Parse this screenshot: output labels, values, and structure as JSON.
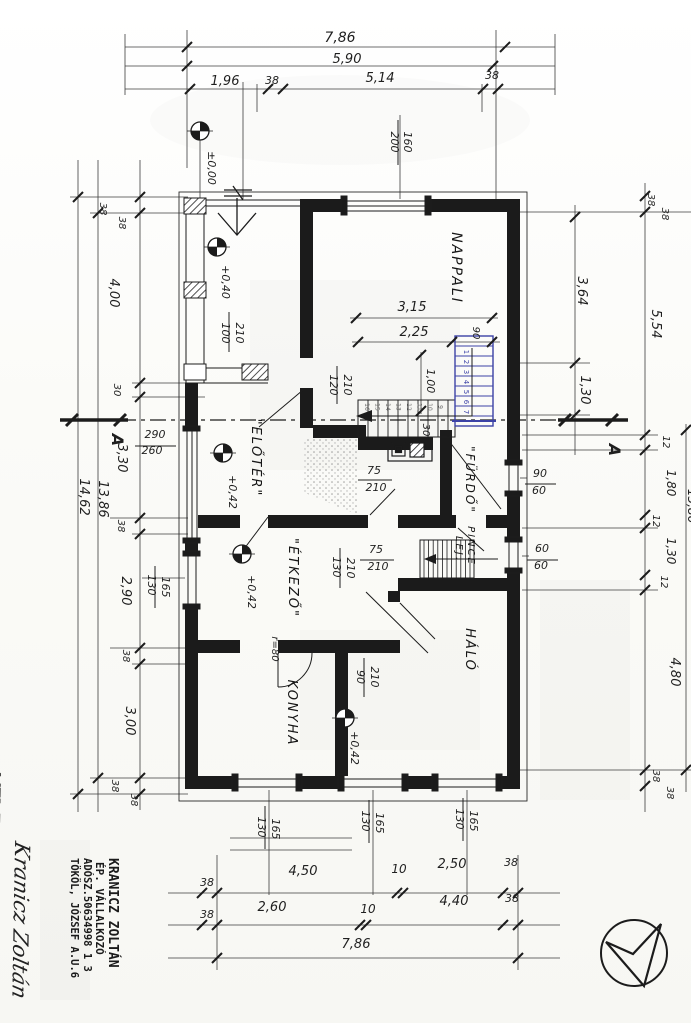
{
  "meta": {
    "drawing_type": "hand-drawn house floor plan (scanned, rotated 90°)",
    "language": "Hungarian"
  },
  "colors": {
    "ink": "#1f1f1f",
    "thin_line": "#3c3c3c",
    "blue_pen": "#3c42a6",
    "pencil": "#6a6a6a",
    "paper": "#fcfcfa"
  },
  "rooms_visible": [
    "NAPPALI",
    "ELŐTÉR",
    "FÜRDŐ",
    "PINCE LEJ.",
    "ÉTKEZŐ",
    "KONYHA",
    "HÁLÓ"
  ],
  "level_marks": [
    {
      "x": 200,
      "y": 131
    },
    {
      "x": 217,
      "y": 247
    },
    {
      "x": 223,
      "y": 453
    },
    {
      "x": 242,
      "y": 554
    },
    {
      "x": 345,
      "y": 718
    }
  ],
  "labels": [
    {
      "t": "7,86",
      "x": 340,
      "y": 42,
      "r": 0,
      "s": 14
    },
    {
      "t": "5,90",
      "x": 347,
      "y": 63,
      "r": 0,
      "s": 13
    },
    {
      "t": "1,96",
      "x": 225,
      "y": 85,
      "r": 0,
      "s": 13
    },
    {
      "t": "38",
      "x": 272,
      "y": 84,
      "r": 0,
      "s": 11
    },
    {
      "t": "5,14",
      "x": 380,
      "y": 82,
      "r": 0,
      "s": 13
    },
    {
      "t": "38",
      "x": 492,
      "y": 79,
      "r": 0,
      "s": 11
    },
    {
      "t": "±0,00",
      "x": 208,
      "y": 168,
      "r": 90,
      "s": 11
    },
    {
      "t": "200",
      "x": 391,
      "y": 142,
      "r": 90,
      "s": 11
    },
    {
      "t": "160",
      "x": 404,
      "y": 142,
      "r": 90,
      "s": 11
    },
    {
      "t": "38",
      "x": 100,
      "y": 209,
      "r": 90,
      "s": 10
    },
    {
      "t": "38",
      "x": 119,
      "y": 223,
      "r": 90,
      "s": 10
    },
    {
      "t": "4,00",
      "x": 110,
      "y": 293,
      "r": 90,
      "s": 13
    },
    {
      "t": "30",
      "x": 114,
      "y": 390,
      "r": 90,
      "s": 10
    },
    {
      "t": "3,30",
      "x": 118,
      "y": 458,
      "r": 90,
      "s": 13
    },
    {
      "t": "14,62",
      "x": 80,
      "y": 497,
      "r": 90,
      "s": 13
    },
    {
      "t": "13,86",
      "x": 99,
      "y": 499,
      "r": 90,
      "s": 13
    },
    {
      "t": "38",
      "x": 118,
      "y": 526,
      "r": 90,
      "s": 10
    },
    {
      "t": "2,90",
      "x": 122,
      "y": 591,
      "r": 90,
      "s": 13
    },
    {
      "t": "130",
      "x": 148,
      "y": 585,
      "r": 90,
      "s": 11
    },
    {
      "t": "165",
      "x": 162,
      "y": 587,
      "r": 90,
      "s": 11
    },
    {
      "t": "38",
      "x": 123,
      "y": 656,
      "r": 90,
      "s": 10
    },
    {
      "t": "3,00",
      "x": 126,
      "y": 721,
      "r": 90,
      "s": 13
    },
    {
      "t": "38",
      "x": 112,
      "y": 786,
      "r": 90,
      "s": 10
    },
    {
      "t": "38",
      "x": 131,
      "y": 800,
      "r": 90,
      "s": 10
    },
    {
      "t": "+0,40",
      "x": 222,
      "y": 282,
      "r": 90,
      "s": 11
    },
    {
      "t": "100",
      "x": 222,
      "y": 333,
      "r": 90,
      "s": 11
    },
    {
      "t": "210",
      "x": 236,
      "y": 333,
      "r": 90,
      "s": 11
    },
    {
      "t": "290",
      "x": 155,
      "y": 438,
      "r": 0,
      "s": 11
    },
    {
      "t": "260",
      "x": 152,
      "y": 454,
      "r": 0,
      "s": 11
    },
    {
      "t": "\"ELŐTÉR\"",
      "x": 252,
      "y": 458,
      "r": 90,
      "s": 13,
      "c": "room"
    },
    {
      "t": "+0,42",
      "x": 229,
      "y": 492,
      "r": 90,
      "s": 11
    },
    {
      "t": "NAPPALI",
      "x": 452,
      "y": 268,
      "r": 90,
      "s": 14,
      "c": "room"
    },
    {
      "t": "3,15",
      "x": 412,
      "y": 311,
      "r": 0,
      "s": 13
    },
    {
      "t": "2,25",
      "x": 414,
      "y": 336,
      "r": 0,
      "s": 13
    },
    {
      "t": "90",
      "x": 473,
      "y": 333,
      "r": 90,
      "s": 10
    },
    {
      "t": "120",
      "x": 330,
      "y": 385,
      "r": 90,
      "s": 11
    },
    {
      "t": "210",
      "x": 344,
      "y": 385,
      "r": 90,
      "s": 11
    },
    {
      "t": "1,00",
      "x": 427,
      "y": 381,
      "r": 90,
      "s": 11
    },
    {
      "t": "30",
      "x": 423,
      "y": 430,
      "r": 90,
      "s": 10
    },
    {
      "t": "75",
      "x": 374,
      "y": 474,
      "r": 0,
      "s": 11
    },
    {
      "t": "210",
      "x": 376,
      "y": 491,
      "r": 0,
      "s": 11
    },
    {
      "t": "\"FÜRDŐ\"",
      "x": 466,
      "y": 480,
      "r": 90,
      "s": 12,
      "c": "room"
    },
    {
      "t": "90",
      "x": 540,
      "y": 477,
      "r": 0,
      "s": 11
    },
    {
      "t": "60",
      "x": 539,
      "y": 494,
      "r": 0,
      "s": 11
    },
    {
      "t": "PINCE",
      "x": 468,
      "y": 546,
      "r": 90,
      "s": 10,
      "c": "room"
    },
    {
      "t": "LEJ.",
      "x": 456,
      "y": 549,
      "r": 90,
      "s": 10,
      "c": "room"
    },
    {
      "t": "60",
      "x": 542,
      "y": 552,
      "r": 0,
      "s": 11
    },
    {
      "t": "60",
      "x": 541,
      "y": 569,
      "r": 0,
      "s": 11
    },
    {
      "t": "75",
      "x": 376,
      "y": 553,
      "r": 0,
      "s": 11
    },
    {
      "t": "210",
      "x": 378,
      "y": 570,
      "r": 0,
      "s": 11
    },
    {
      "t": "130",
      "x": 333,
      "y": 567,
      "r": 90,
      "s": 11
    },
    {
      "t": "210",
      "x": 347,
      "y": 568,
      "r": 90,
      "s": 11
    },
    {
      "t": "\"ÉTKEZŐ\"",
      "x": 289,
      "y": 578,
      "r": 90,
      "s": 13,
      "c": "room"
    },
    {
      "t": "+0,42",
      "x": 248,
      "y": 592,
      "r": 90,
      "s": 11
    },
    {
      "t": "HÁLÓ",
      "x": 466,
      "y": 650,
      "r": 90,
      "s": 13,
      "c": "room"
    },
    {
      "t": "90",
      "x": 357,
      "y": 677,
      "r": 90,
      "s": 11
    },
    {
      "t": "210",
      "x": 371,
      "y": 677,
      "r": 90,
      "s": 11
    },
    {
      "t": "r=80",
      "x": 272,
      "y": 649,
      "r": 90,
      "s": 10
    },
    {
      "t": "KONYHA",
      "x": 288,
      "y": 713,
      "r": 90,
      "s": 13,
      "c": "room"
    },
    {
      "t": "+0,42",
      "x": 351,
      "y": 748,
      "r": 90,
      "s": 11
    },
    {
      "t": "130",
      "x": 258,
      "y": 827,
      "r": 90,
      "s": 11
    },
    {
      "t": "165",
      "x": 272,
      "y": 829,
      "r": 90,
      "s": 11
    },
    {
      "t": "130",
      "x": 362,
      "y": 821,
      "r": 90,
      "s": 11
    },
    {
      "t": "165",
      "x": 376,
      "y": 823,
      "r": 90,
      "s": 11
    },
    {
      "t": "130",
      "x": 456,
      "y": 819,
      "r": 90,
      "s": 11
    },
    {
      "t": "165",
      "x": 470,
      "y": 821,
      "r": 90,
      "s": 11
    },
    {
      "t": "3,64",
      "x": 578,
      "y": 291,
      "r": 90,
      "s": 13
    },
    {
      "t": "1,30",
      "x": 581,
      "y": 390,
      "r": 90,
      "s": 13
    },
    {
      "t": "A",
      "x": 112,
      "y": 440,
      "r": 90,
      "s": 16,
      "c": "sec"
    },
    {
      "t": "A",
      "x": 609,
      "y": 450,
      "r": 90,
      "s": 16,
      "c": "sec"
    },
    {
      "t": "38",
      "x": 648,
      "y": 200,
      "r": 90,
      "s": 10
    },
    {
      "t": "38",
      "x": 662,
      "y": 214,
      "r": 90,
      "s": 10
    },
    {
      "t": "5,54",
      "x": 652,
      "y": 324,
      "r": 90,
      "s": 13
    },
    {
      "t": "12",
      "x": 663,
      "y": 442,
      "r": 90,
      "s": 10
    },
    {
      "t": "1,80",
      "x": 667,
      "y": 483,
      "r": 90,
      "s": 12
    },
    {
      "t": "12",
      "x": 653,
      "y": 521,
      "r": 90,
      "s": 10
    },
    {
      "t": "1,30",
      "x": 667,
      "y": 551,
      "r": 90,
      "s": 12
    },
    {
      "t": "12",
      "x": 661,
      "y": 582,
      "r": 90,
      "s": 10
    },
    {
      "t": "4,80",
      "x": 671,
      "y": 672,
      "r": 90,
      "s": 13
    },
    {
      "t": "38",
      "x": 653,
      "y": 776,
      "r": 90,
      "s": 10
    },
    {
      "t": "38",
      "x": 667,
      "y": 793,
      "r": 90,
      "s": 10
    },
    {
      "t": "13,86",
      "x": 688,
      "y": 506,
      "r": 90,
      "s": 12
    },
    {
      "t": "38",
      "x": 207,
      "y": 886,
      "r": 0,
      "s": 11
    },
    {
      "t": "4,50",
      "x": 303,
      "y": 875,
      "r": 0,
      "s": 13
    },
    {
      "t": "10",
      "x": 399,
      "y": 873,
      "r": 0,
      "s": 12
    },
    {
      "t": "2,50",
      "x": 452,
      "y": 868,
      "r": 0,
      "s": 13
    },
    {
      "t": "38",
      "x": 511,
      "y": 866,
      "r": 0,
      "s": 11
    },
    {
      "t": "38",
      "x": 207,
      "y": 918,
      "r": 0,
      "s": 11
    },
    {
      "t": "2,60",
      "x": 272,
      "y": 911,
      "r": 0,
      "s": 13
    },
    {
      "t": "10",
      "x": 368,
      "y": 913,
      "r": 0,
      "s": 12
    },
    {
      "t": "4,40",
      "x": 454,
      "y": 905,
      "r": 0,
      "s": 13
    },
    {
      "t": "38",
      "x": 512,
      "y": 902,
      "r": 0,
      "s": 11
    },
    {
      "t": "7,86",
      "x": 356,
      "y": 948,
      "r": 0,
      "s": 13
    }
  ],
  "fraction_bars": [
    [
      398,
      120,
      398,
      165
    ],
    [
      155,
      566,
      155,
      608
    ],
    [
      229,
      312,
      229,
      352
    ],
    [
      135,
      446,
      176,
      446
    ],
    [
      337,
      366,
      337,
      404
    ],
    [
      358,
      480,
      392,
      480
    ],
    [
      525,
      484,
      556,
      484
    ],
    [
      527,
      560,
      558,
      560
    ],
    [
      360,
      560,
      394,
      560
    ],
    [
      340,
      548,
      340,
      588
    ],
    [
      364,
      658,
      364,
      697
    ],
    [
      265,
      806,
      265,
      849
    ],
    [
      369,
      800,
      369,
      843
    ],
    [
      463,
      798,
      463,
      841
    ]
  ],
  "stair": {
    "pencil_numbers": [
      "16",
      "15",
      "14",
      "13",
      "12",
      "11",
      "10",
      "9"
    ],
    "blue_numbers": [
      "1",
      "2",
      "3",
      "4",
      "5",
      "6",
      "7"
    ]
  },
  "title_block": {
    "line1": "KRANICZ ZOLTÁN",
    "line2": "ÉP. VÁLLALKOZÓ",
    "line3": "ADÓSZ.50634998 1 3",
    "line4": "TÖKÖL, JÓZSEF A.U.6",
    "signature": "Kranicz Zoltán",
    "note": "MTJ: E-3-89-83"
  }
}
